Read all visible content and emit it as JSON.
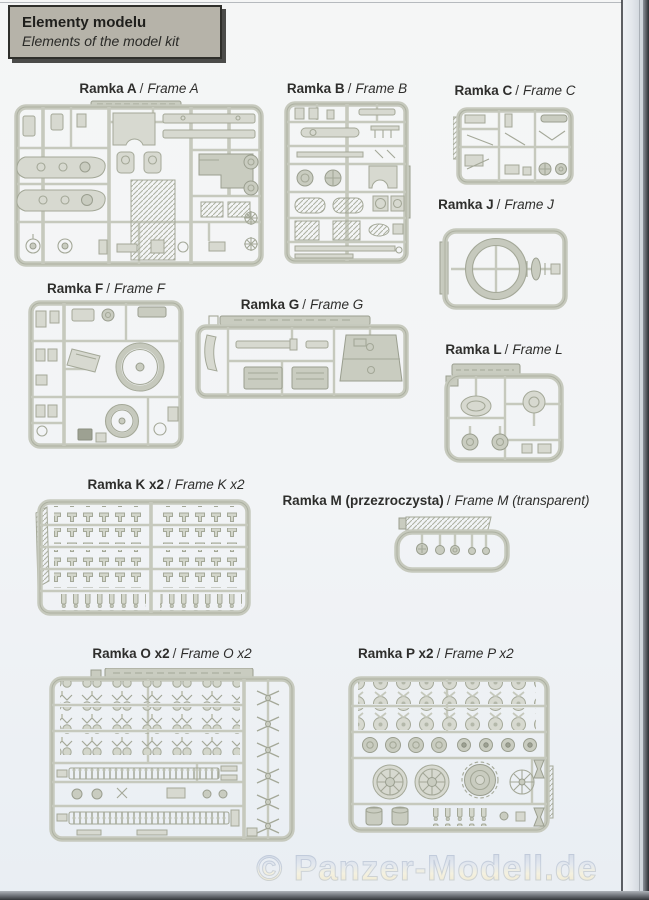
{
  "header": {
    "title_pl": "Elementy modelu",
    "title_en": "Elements of the model kit"
  },
  "labels": {
    "separator": "/"
  },
  "frames": {
    "a": {
      "name_pl": "Ramka A",
      "name_en": "Frame A"
    },
    "b": {
      "name_pl": "Ramka B",
      "name_en": "Frame B"
    },
    "c": {
      "name_pl": "Ramka C",
      "name_en": "Frame C"
    },
    "j": {
      "name_pl": "Ramka J",
      "name_en": "Frame J"
    },
    "f": {
      "name_pl": "Ramka F",
      "name_en": "Frame F"
    },
    "g": {
      "name_pl": "Ramka G",
      "name_en": "Frame G"
    },
    "l": {
      "name_pl": "Ramka L",
      "name_en": "Frame L"
    },
    "k": {
      "name_pl": "Ramka K x2",
      "name_en": "Frame K x2"
    },
    "m": {
      "name_pl": "Ramka M (przezroczysta)",
      "name_en": "Frame M (transparent)"
    },
    "o": {
      "name_pl": "Ramka O x2",
      "name_en": "Frame O x2"
    },
    "p": {
      "name_pl": "Ramka P x2",
      "name_en": "Frame P x2"
    }
  },
  "watermark": "© Panzer-Modell.de",
  "colors": {
    "header_bg": "#b6b3a9",
    "sprue": "#c6c9bd",
    "sprue_part": "#d7d9d0",
    "label_text": "#2e2e2c",
    "page_bg": "#f2f4f6",
    "watermark_blue": "#c9d3e2",
    "watermark_cream": "#f2ecd2"
  }
}
